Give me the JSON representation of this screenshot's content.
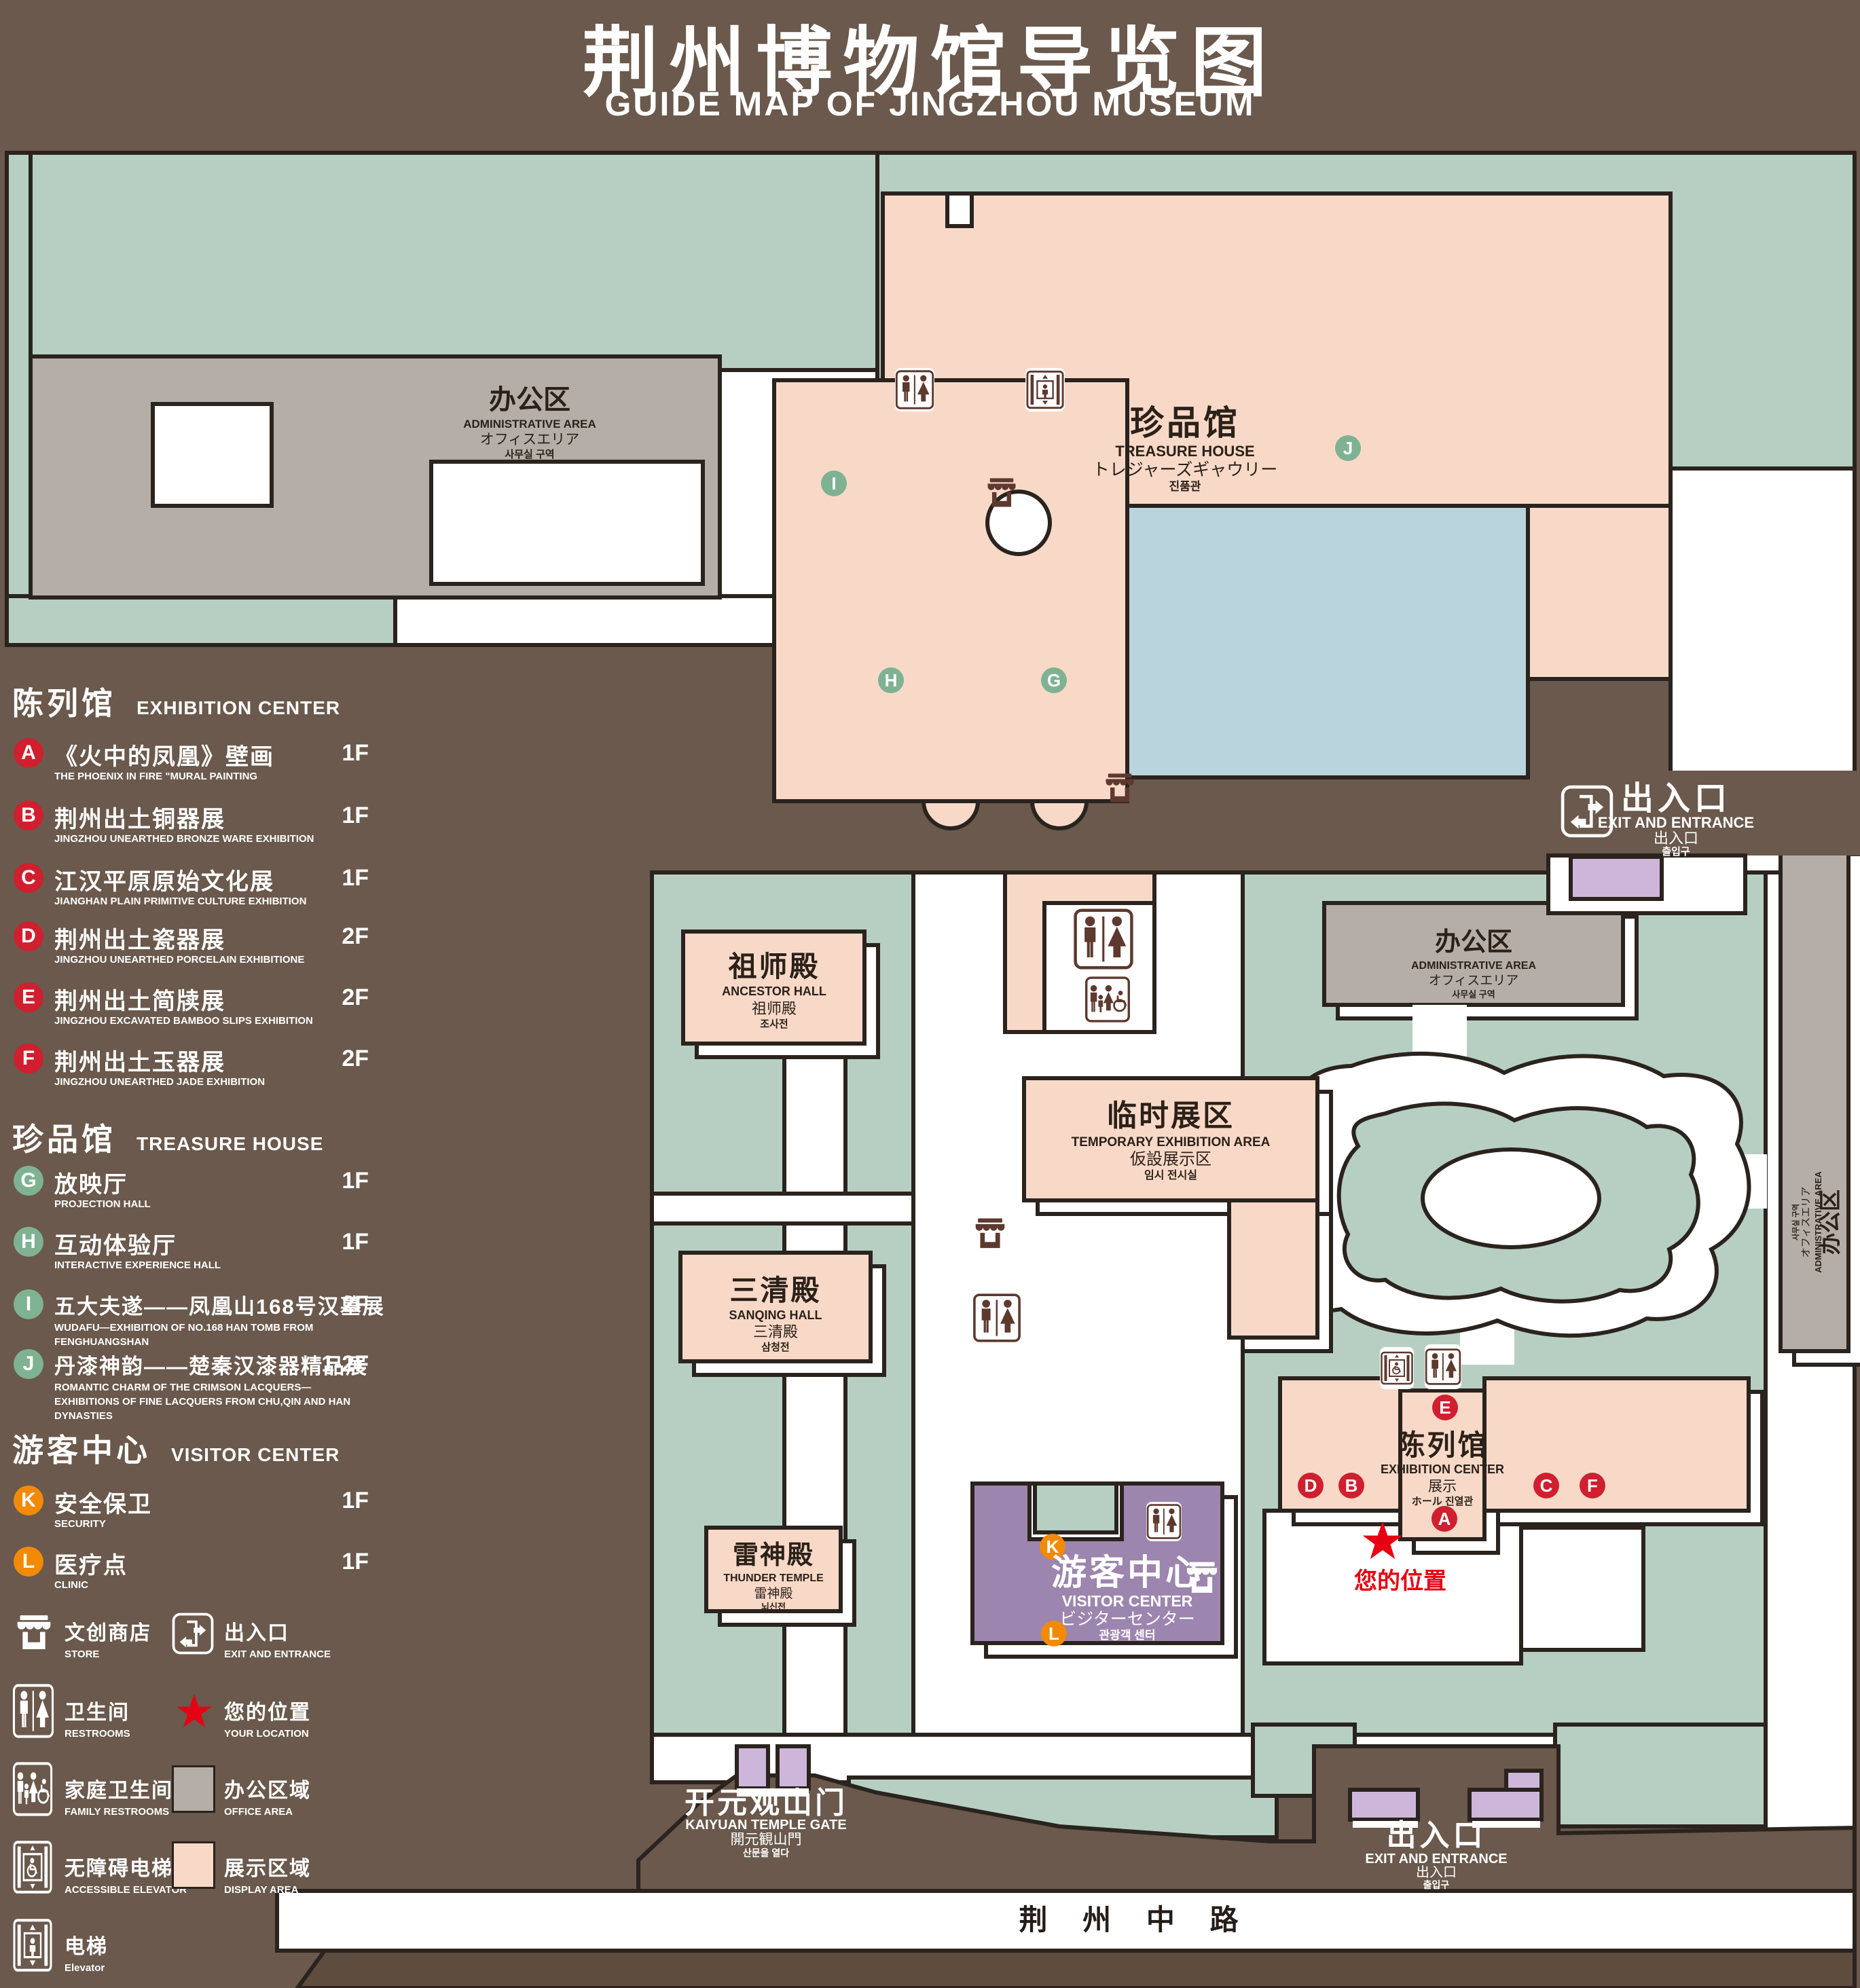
{
  "title": {
    "zh": "荆州博物馆导览图",
    "en": "GUIDE MAP OF JINGZHOU MUSEUM"
  },
  "colors": {
    "background": "#6a594c",
    "green_area": "#b7cfc2",
    "display_area_pink": "#f8d9c8",
    "office_gray": "#b5aea8",
    "visitor_purple": "#9c85ae",
    "exit_purple": "#cdb6da",
    "pond_blue": "#bad4de",
    "outline": "#2a231e",
    "badge_red": "#d01f2f",
    "badge_green": "#7fb292",
    "badge_orange": "#f28a05",
    "location_red": "#e60012",
    "road_brown": "#5e4c3e"
  },
  "legend": {
    "sections": [
      {
        "zh": "陈列馆",
        "en": "EXHIBITION CENTER",
        "items": [
          {
            "letter": "A",
            "zh": "《火中的凤凰》壁画",
            "en": "THE PHOENIX IN FIRE \"MURAL PAINTING",
            "floor": "1F"
          },
          {
            "letter": "B",
            "zh": "荆州出土铜器展",
            "en": "JINGZHOU UNEARTHED BRONZE WARE EXHIBITION",
            "floor": "1F"
          },
          {
            "letter": "C",
            "zh": "江汉平原原始文化展",
            "en": "JIANGHAN PLAIN PRIMITIVE CULTURE EXHIBITION",
            "floor": "1F"
          },
          {
            "letter": "D",
            "zh": "荆州出土瓷器展",
            "en": "JINGZHOU UNEARTHED PORCELAIN EXHIBITIONE",
            "floor": "2F"
          },
          {
            "letter": "E",
            "zh": "荆州出土简牍展",
            "en": "JINGZHOU EXCAVATED BAMBOO SLIPS EXHIBITION",
            "floor": "2F"
          },
          {
            "letter": "F",
            "zh": "荆州出土玉器展",
            "en": "JINGZHOU UNEARTHED JADE EXHIBITION",
            "floor": "2F"
          }
        ]
      },
      {
        "zh": "珍品馆",
        "en": "TREASURE HOUSE",
        "items": [
          {
            "letter": "G",
            "zh": "放映厅",
            "en": "PROJECTION HALL",
            "floor": "1F"
          },
          {
            "letter": "H",
            "zh": "互动体验厅",
            "en": "INTERACTIVE EXPERIENCE HALL",
            "floor": "1F"
          },
          {
            "letter": "I",
            "zh": "五大夫遂——凤凰山168号汉墓展",
            "en": "WUDAFU—EXHIBITION OF NO.168 HAN TOMB FROM FENGHUANGSHAN",
            "floor": "2F"
          },
          {
            "letter": "J",
            "zh": "丹漆神韵——楚秦汉漆器精品展",
            "en": "ROMANTIC CHARM OF THE CRIMSON LACQUERS—EXHIBITIONS OF FINE LACQUERS FROM CHU,QIN AND HAN DYNASTIES",
            "floor": "1-2F"
          }
        ]
      },
      {
        "zh": "游客中心",
        "en": "VISITOR CENTER",
        "items": [
          {
            "letter": "K",
            "zh": "安全保卫",
            "en": "SECURITY",
            "floor": "1F"
          },
          {
            "letter": "L",
            "zh": "医疗点",
            "en": "CLINIC",
            "floor": "1F"
          }
        ]
      }
    ],
    "icons": [
      {
        "icon": "store-icon",
        "zh": "文创商店",
        "en": "STORE"
      },
      {
        "icon": "exit-icon",
        "zh": "出入口",
        "en": "EXIT AND ENTRANCE"
      },
      {
        "icon": "restrooms-icon",
        "zh": "卫生间",
        "en": "RESTROOMS"
      },
      {
        "icon": "location-star-icon",
        "zh": "您的位置",
        "en": "YOUR LOCATION"
      },
      {
        "icon": "family-restrooms-icon",
        "zh": "家庭卫生间",
        "en": "FAMILY RESTROOMS"
      },
      {
        "icon": "office-area-swatch",
        "zh": "办公区域",
        "en": "OFFICE AREA"
      },
      {
        "icon": "accessible-elevator-icon",
        "zh": "无障碍电梯",
        "en": "ACCESSIBLE ELEVATOR"
      },
      {
        "icon": "display-area-swatch",
        "zh": "展示区域",
        "en": "DISPLAY AREA"
      },
      {
        "icon": "elevator-icon",
        "zh": "电梯",
        "en": "Elevator"
      }
    ]
  },
  "map": {
    "admin": {
      "zh": "办公区",
      "en": "ADMINISTRATIVE AREA",
      "jp": "オフィスエリア",
      "kr": "사무실 구역"
    },
    "treasure": {
      "zh": "珍品馆",
      "en": "TREASURE HOUSE",
      "jp": "トレジャーズギャウリー",
      "kr": "진품관"
    },
    "ancestor": {
      "zh": "祖师殿",
      "en": "ANCESTOR HALL",
      "jp": "祖师殿",
      "kr": "조사전"
    },
    "temporary": {
      "zh": "临时展区",
      "en": "TEMPORARY EXHIBITION AREA",
      "jp": "仮設展示区",
      "kr": "임시 전시실"
    },
    "sanqing": {
      "zh": "三清殿",
      "en": "SANQING HALL",
      "jp": "三清殿",
      "kr": "삼청전"
    },
    "thunder": {
      "zh": "雷神殿",
      "en": "THUNDER TEMPLE",
      "jp": "雷神殿",
      "kr": "뇌신전"
    },
    "visitor": {
      "zh": "游客中心",
      "en": "VISITOR CENTER",
      "jp": "ビジターセンター",
      "kr": "관광객 센터"
    },
    "exhibition": {
      "zh": "陈列馆",
      "en": "EXHIBITION CENTER",
      "jp": "展示",
      "kr": "ホール 진열관"
    },
    "exit": {
      "zh": "出入口",
      "en": "EXIT AND ENTRANCE",
      "jp": "出入口",
      "kr": "출입구"
    },
    "gate": {
      "zh": "开元观山门",
      "en": "KAIYUAN TEMPLE GATE",
      "jp": "開元観山門",
      "kr": "산문을 열다"
    },
    "road": {
      "zh": "荆 州 中 路"
    },
    "your_location": {
      "zh": "您的位置"
    }
  }
}
